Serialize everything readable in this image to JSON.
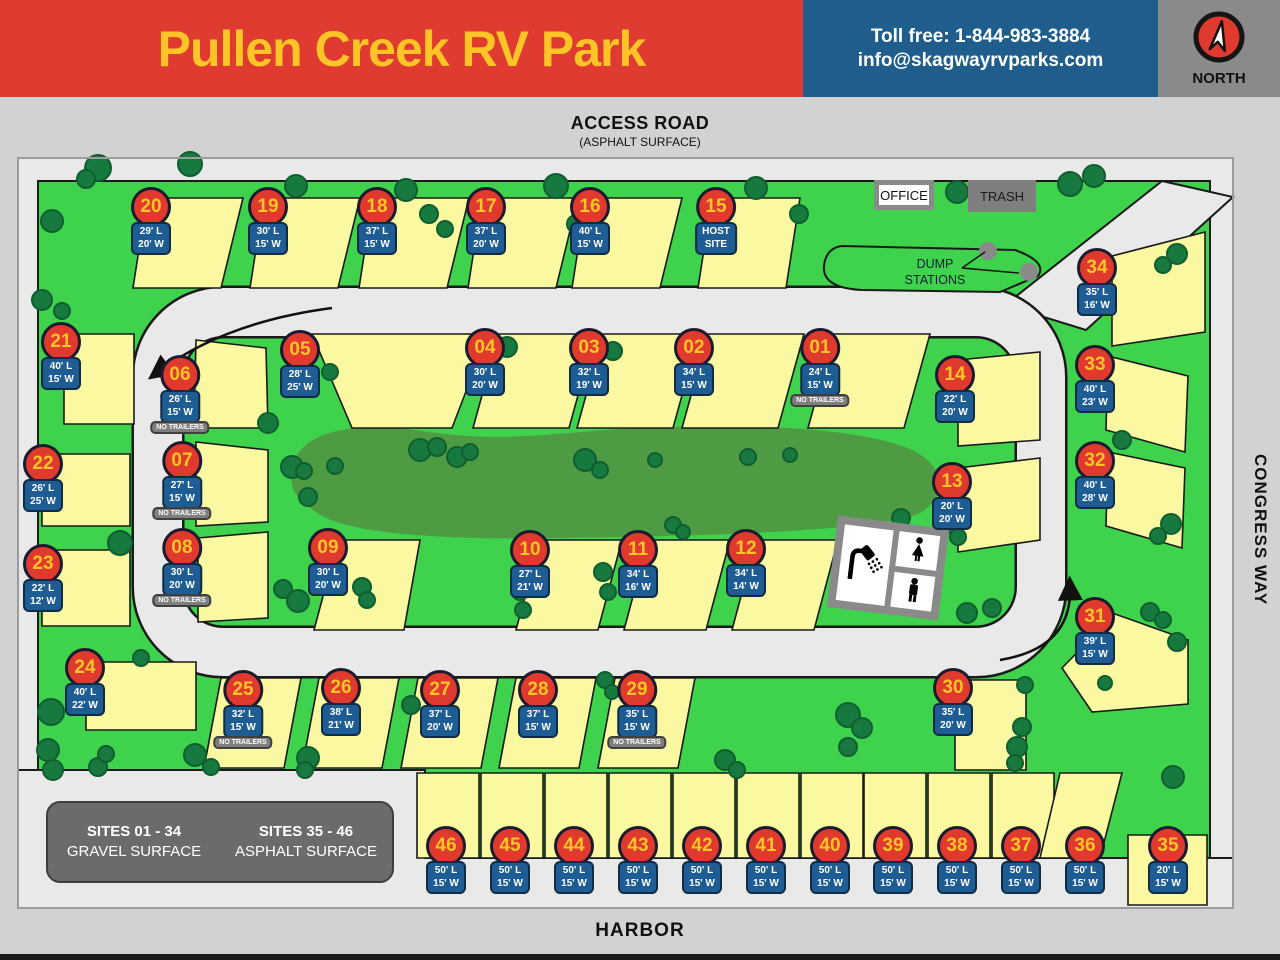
{
  "header": {
    "title": "Pullen Creek RV Park",
    "phone": "Toll free: 1-844-983-3884",
    "email": "info@skagwayrvparks.com",
    "compass_label": "NORTH"
  },
  "roads": {
    "access_road": "ACCESS ROAD",
    "access_road_sub": "(ASPHALT SURFACE)",
    "congress_way": "CONGRESS WAY",
    "harbor": "HARBOR"
  },
  "facilities": {
    "office": "OFFICE",
    "trash": "TRASH",
    "dump_line1": "DUMP",
    "dump_line2": "STATIONS"
  },
  "legend": {
    "col1_title": "SITES 01 - 34",
    "col1_sub": "GRAVEL SURFACE",
    "col2_title": "SITES 35 - 46",
    "col2_sub": "ASPHALT SURFACE"
  },
  "labels": {
    "no_trailers": "NO TRAILERS"
  },
  "colors": {
    "header_red": "#E03B30",
    "header_blue": "#1E5D8C",
    "header_gray": "#8A8A8A",
    "title_yellow": "#FFC426",
    "grass_green": "#3FD24C",
    "berm_green": "#4F9B43",
    "tree_green": "#17793F",
    "site_yellow": "#FBF8A2",
    "road_gray": "#E9E9E9",
    "marker_red": "#E0392E",
    "tag_blue": "#1E5D94"
  },
  "sites": [
    {
      "id": "01",
      "dims": [
        "24' L",
        "15' W"
      ],
      "nt": true,
      "x": 820,
      "y": 348
    },
    {
      "id": "02",
      "dims": [
        "34' L",
        "15' W"
      ],
      "nt": false,
      "x": 694,
      "y": 348
    },
    {
      "id": "03",
      "dims": [
        "32' L",
        "19' W"
      ],
      "nt": false,
      "x": 589,
      "y": 348
    },
    {
      "id": "04",
      "dims": [
        "30' L",
        "20' W"
      ],
      "nt": false,
      "x": 485,
      "y": 348
    },
    {
      "id": "05",
      "dims": [
        "28' L",
        "25' W"
      ],
      "nt": false,
      "x": 300,
      "y": 350
    },
    {
      "id": "06",
      "dims": [
        "26' L",
        "15' W"
      ],
      "nt": true,
      "x": 180,
      "y": 375
    },
    {
      "id": "07",
      "dims": [
        "27' L",
        "15' W"
      ],
      "nt": true,
      "x": 182,
      "y": 461
    },
    {
      "id": "08",
      "dims": [
        "30' L",
        "20' W"
      ],
      "nt": true,
      "x": 182,
      "y": 548
    },
    {
      "id": "09",
      "dims": [
        "30' L",
        "20' W"
      ],
      "nt": false,
      "x": 328,
      "y": 548
    },
    {
      "id": "10",
      "dims": [
        "27' L",
        "21' W"
      ],
      "nt": false,
      "x": 530,
      "y": 550
    },
    {
      "id": "11",
      "dims": [
        "34' L",
        "16' W"
      ],
      "nt": false,
      "x": 638,
      "y": 550
    },
    {
      "id": "12",
      "dims": [
        "34' L",
        "14' W"
      ],
      "nt": false,
      "x": 746,
      "y": 549
    },
    {
      "id": "13",
      "dims": [
        "20' L",
        "20' W"
      ],
      "nt": false,
      "x": 952,
      "y": 482
    },
    {
      "id": "14",
      "dims": [
        "22' L",
        "20' W"
      ],
      "nt": false,
      "x": 955,
      "y": 375
    },
    {
      "id": "15",
      "dims": [
        "HOST",
        "SITE"
      ],
      "nt": false,
      "x": 716,
      "y": 207
    },
    {
      "id": "16",
      "dims": [
        "40' L",
        "15' W"
      ],
      "nt": false,
      "x": 590,
      "y": 207
    },
    {
      "id": "17",
      "dims": [
        "37' L",
        "20' W"
      ],
      "nt": false,
      "x": 486,
      "y": 207
    },
    {
      "id": "18",
      "dims": [
        "37' L",
        "15' W"
      ],
      "nt": false,
      "x": 377,
      "y": 207
    },
    {
      "id": "19",
      "dims": [
        "30' L",
        "15' W"
      ],
      "nt": false,
      "x": 268,
      "y": 207
    },
    {
      "id": "20",
      "dims": [
        "29' L",
        "20' W"
      ],
      "nt": false,
      "x": 151,
      "y": 207
    },
    {
      "id": "21",
      "dims": [
        "40' L",
        "15' W"
      ],
      "nt": false,
      "x": 61,
      "y": 342
    },
    {
      "id": "22",
      "dims": [
        "26' L",
        "25' W"
      ],
      "nt": false,
      "x": 43,
      "y": 464
    },
    {
      "id": "23",
      "dims": [
        "22' L",
        "12' W"
      ],
      "nt": false,
      "x": 43,
      "y": 564
    },
    {
      "id": "24",
      "dims": [
        "40' L",
        "22' W"
      ],
      "nt": false,
      "x": 85,
      "y": 668
    },
    {
      "id": "25",
      "dims": [
        "32' L",
        "15' W"
      ],
      "nt": true,
      "x": 243,
      "y": 690
    },
    {
      "id": "26",
      "dims": [
        "38' L",
        "21' W"
      ],
      "nt": false,
      "x": 341,
      "y": 688
    },
    {
      "id": "27",
      "dims": [
        "37' L",
        "20' W"
      ],
      "nt": false,
      "x": 440,
      "y": 690
    },
    {
      "id": "28",
      "dims": [
        "37' L",
        "15' W"
      ],
      "nt": false,
      "x": 538,
      "y": 690
    },
    {
      "id": "29",
      "dims": [
        "35' L",
        "15' W"
      ],
      "nt": true,
      "x": 637,
      "y": 690
    },
    {
      "id": "30",
      "dims": [
        "35' L",
        "20' W"
      ],
      "nt": false,
      "x": 953,
      "y": 688
    },
    {
      "id": "31",
      "dims": [
        "39' L",
        "15' W"
      ],
      "nt": false,
      "x": 1095,
      "y": 617
    },
    {
      "id": "32",
      "dims": [
        "40' L",
        "28' W"
      ],
      "nt": false,
      "x": 1095,
      "y": 461
    },
    {
      "id": "33",
      "dims": [
        "40' L",
        "23' W"
      ],
      "nt": false,
      "x": 1095,
      "y": 365
    },
    {
      "id": "34",
      "dims": [
        "35' L",
        "16' W"
      ],
      "nt": false,
      "x": 1097,
      "y": 268
    },
    {
      "id": "35",
      "dims": [
        "20' L",
        "15' W"
      ],
      "nt": false,
      "x": 1168,
      "y": 846
    },
    {
      "id": "36",
      "dims": [
        "50' L",
        "15' W"
      ],
      "nt": false,
      "x": 1085,
      "y": 846
    },
    {
      "id": "37",
      "dims": [
        "50' L",
        "15' W"
      ],
      "nt": false,
      "x": 1021,
      "y": 846
    },
    {
      "id": "38",
      "dims": [
        "50' L",
        "15' W"
      ],
      "nt": false,
      "x": 957,
      "y": 846
    },
    {
      "id": "39",
      "dims": [
        "50' L",
        "15' W"
      ],
      "nt": false,
      "x": 893,
      "y": 846
    },
    {
      "id": "40",
      "dims": [
        "50' L",
        "15' W"
      ],
      "nt": false,
      "x": 830,
      "y": 846
    },
    {
      "id": "41",
      "dims": [
        "50' L",
        "15' W"
      ],
      "nt": false,
      "x": 766,
      "y": 846
    },
    {
      "id": "42",
      "dims": [
        "50' L",
        "15' W"
      ],
      "nt": false,
      "x": 702,
      "y": 846
    },
    {
      "id": "43",
      "dims": [
        "50' L",
        "15' W"
      ],
      "nt": false,
      "x": 638,
      "y": 846
    },
    {
      "id": "44",
      "dims": [
        "50' L",
        "15' W"
      ],
      "nt": false,
      "x": 574,
      "y": 846
    },
    {
      "id": "45",
      "dims": [
        "50' L",
        "15' W"
      ],
      "nt": false,
      "x": 510,
      "y": 846
    },
    {
      "id": "46",
      "dims": [
        "50' L",
        "15' W"
      ],
      "nt": false,
      "x": 446,
      "y": 846
    }
  ]
}
